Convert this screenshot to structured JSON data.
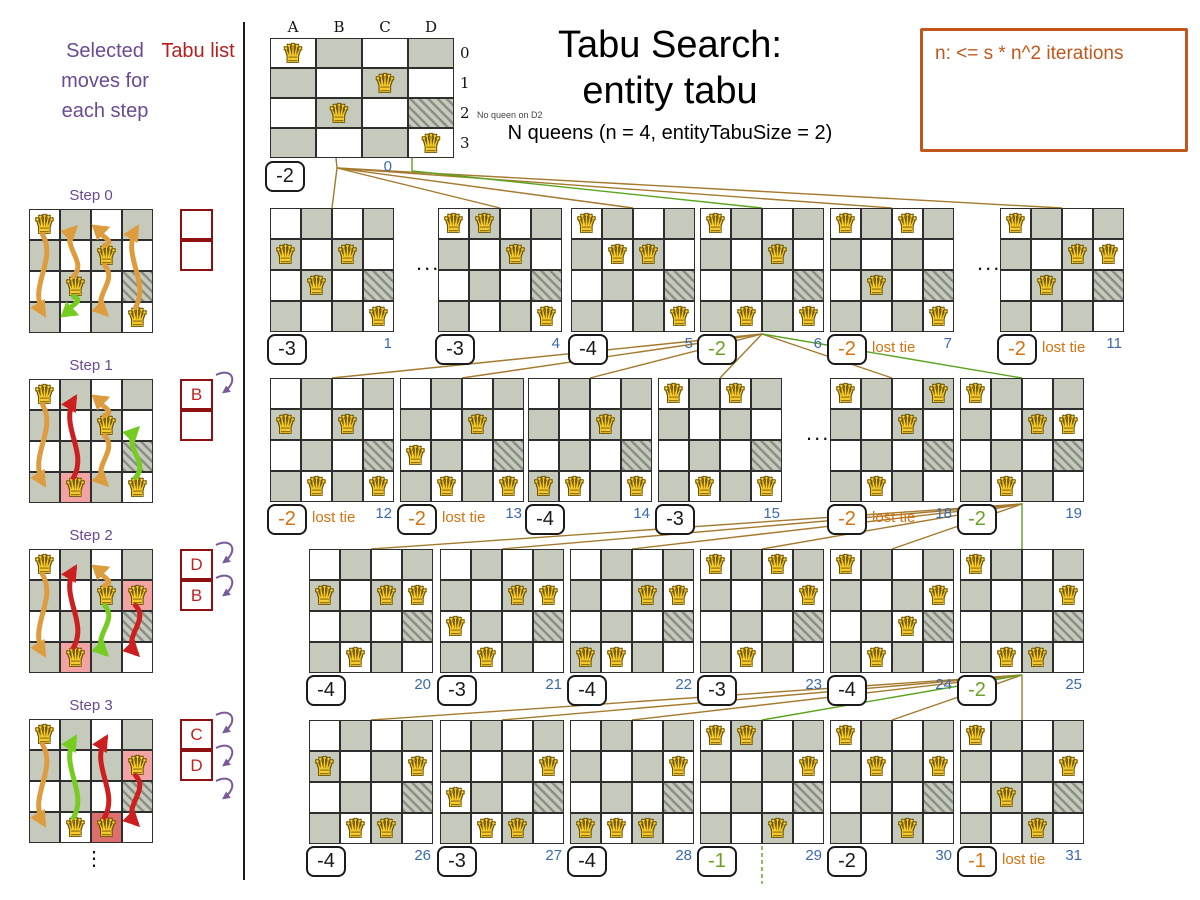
{
  "left_panel": {
    "moves_header": "Selected moves for each step",
    "tabu_header": "Tabu list",
    "ellipsis": "⋮",
    "steps": [
      {
        "label": "Step 0",
        "queens": [
          "A0",
          "C1",
          "B2",
          "D3"
        ],
        "tabu_cell": "D2",
        "highlights": [],
        "tabu_list": [
          "",
          ""
        ],
        "arrow_count": 0,
        "arrows": [
          {
            "col": "A",
            "from": 0,
            "to": 3,
            "color": "orange"
          },
          {
            "col": "B",
            "from": 2,
            "to": 0,
            "color": "orange"
          },
          {
            "col": "B",
            "from": 2,
            "to": 3,
            "color": "green"
          },
          {
            "col": "C",
            "from": 1,
            "to": 0,
            "color": "orange"
          },
          {
            "col": "C",
            "from": 1,
            "to": 3,
            "color": "orange"
          },
          {
            "col": "D",
            "from": 3,
            "to": 0,
            "color": "orange"
          }
        ]
      },
      {
        "label": "Step 1",
        "queens": [
          "A0",
          "C1",
          "B3",
          "D3"
        ],
        "tabu_cell": "D2",
        "highlights": [
          {
            "cell": "B3",
            "strength": "light"
          }
        ],
        "tabu_list": [
          "B",
          ""
        ],
        "arrow_count": 1,
        "arrows": [
          {
            "col": "A",
            "from": 0,
            "to": 3,
            "color": "orange"
          },
          {
            "col": "B",
            "from": 3,
            "to": 0,
            "color": "red"
          },
          {
            "col": "C",
            "from": 1,
            "to": 0,
            "color": "orange"
          },
          {
            "col": "C",
            "from": 1,
            "to": 3,
            "color": "orange"
          },
          {
            "col": "D",
            "from": 3,
            "to": 1,
            "color": "green"
          }
        ]
      },
      {
        "label": "Step 2",
        "queens": [
          "A0",
          "C1",
          "D1",
          "B3"
        ],
        "tabu_cell": "D2",
        "highlights": [
          {
            "cell": "D1",
            "strength": "light"
          },
          {
            "cell": "B3",
            "strength": "light"
          }
        ],
        "tabu_list": [
          "D",
          "B"
        ],
        "arrow_count": 2,
        "arrows": [
          {
            "col": "A",
            "from": 0,
            "to": 3,
            "color": "orange"
          },
          {
            "col": "B",
            "from": 3,
            "to": 0,
            "color": "red"
          },
          {
            "col": "C",
            "from": 1,
            "to": 0,
            "color": "orange"
          },
          {
            "col": "C",
            "from": 1,
            "to": 3,
            "color": "green"
          },
          {
            "col": "D",
            "from": 1,
            "to": 3,
            "color": "red"
          }
        ]
      },
      {
        "label": "Step 3",
        "queens": [
          "A0",
          "D1",
          "B3",
          "C3"
        ],
        "tabu_cell": "D2",
        "highlights": [
          {
            "cell": "D1",
            "strength": "light"
          },
          {
            "cell": "C3",
            "strength": "strong"
          }
        ],
        "tabu_list": [
          "C",
          "D"
        ],
        "arrow_count": 3,
        "arrows": [
          {
            "col": "A",
            "from": 0,
            "to": 3,
            "color": "orange"
          },
          {
            "col": "B",
            "from": 3,
            "to": 0,
            "color": "green"
          },
          {
            "col": "C",
            "from": 3,
            "to": 0,
            "color": "red"
          },
          {
            "col": "D",
            "from": 1,
            "to": 3,
            "color": "red"
          }
        ]
      }
    ]
  },
  "header": {
    "title_line1": "Tabu Search:",
    "title_line2": "entity tabu",
    "subtitle": "N queens (n = 4, entityTabuSize = 2)",
    "note": "n: <= s * n^2 iterations"
  },
  "start_board": {
    "column_labels": [
      "A",
      "B",
      "C",
      "D"
    ],
    "row_labels": [
      "0",
      "1",
      "2",
      "3"
    ],
    "queens": [
      "A0",
      "C1",
      "B2",
      "D3"
    ],
    "tabu_cell": "D2",
    "annotation": "No queen on D2",
    "score": "-2",
    "index": "0"
  },
  "dots_label": "...",
  "lost_tie_label": "lost tie",
  "move_boards": [
    {
      "index": "1",
      "row": 1,
      "slot": 0,
      "score": "-3",
      "color": "black",
      "lost_tie": false,
      "selected": false,
      "queens": [
        "A1",
        "C1",
        "B2",
        "D3"
      ],
      "tabu_cell": "D2"
    },
    {
      "index": "4",
      "row": 1,
      "slot": 1,
      "score": "-3",
      "color": "black",
      "lost_tie": false,
      "selected": false,
      "queens": [
        "A0",
        "B0",
        "C1",
        "D3"
      ],
      "tabu_cell": "D2"
    },
    {
      "index": "5",
      "row": 1,
      "slot": 2,
      "score": "-4",
      "color": "black",
      "lost_tie": false,
      "selected": false,
      "queens": [
        "A0",
        "B1",
        "C1",
        "D3"
      ],
      "tabu_cell": "D2"
    },
    {
      "index": "6",
      "row": 1,
      "slot": 3,
      "score": "-2",
      "color": "green",
      "lost_tie": false,
      "selected": true,
      "queens": [
        "A0",
        "C1",
        "B3",
        "D3"
      ],
      "tabu_cell": "D2"
    },
    {
      "index": "7",
      "row": 1,
      "slot": 4,
      "score": "-2",
      "color": "orange",
      "lost_tie": true,
      "selected": false,
      "queens": [
        "A0",
        "C0",
        "B2",
        "D3"
      ],
      "tabu_cell": "D2"
    },
    {
      "index": "11",
      "row": 1,
      "slot": 5,
      "score": "-2",
      "color": "orange",
      "lost_tie": true,
      "selected": false,
      "queens": [
        "A0",
        "C1",
        "D1",
        "B2"
      ],
      "tabu_cell": "D2"
    },
    {
      "index": "12",
      "row": 2,
      "slot": 0,
      "score": "-2",
      "color": "orange",
      "lost_tie": true,
      "selected": false,
      "queens": [
        "A1",
        "C1",
        "B3",
        "D3"
      ],
      "tabu_cell": "D2"
    },
    {
      "index": "13",
      "row": 2,
      "slot": 1,
      "score": "-2",
      "color": "orange",
      "lost_tie": true,
      "selected": false,
      "queens": [
        "A2",
        "C1",
        "B3",
        "D3"
      ],
      "tabu_cell": "D2"
    },
    {
      "index": "14",
      "row": 2,
      "slot": 2,
      "score": "-4",
      "color": "black",
      "lost_tie": false,
      "selected": false,
      "queens": [
        "A3",
        "C1",
        "B3",
        "D3"
      ],
      "tabu_cell": "D2"
    },
    {
      "index": "15",
      "row": 2,
      "slot": 3,
      "score": "-3",
      "color": "black",
      "lost_tie": false,
      "selected": false,
      "queens": [
        "A0",
        "C0",
        "B3",
        "D3"
      ],
      "tabu_cell": "D2"
    },
    {
      "index": "18",
      "row": 2,
      "slot": 4,
      "score": "-2",
      "color": "orange",
      "lost_tie": true,
      "selected": false,
      "queens": [
        "A0",
        "D0",
        "C1",
        "B3"
      ],
      "tabu_cell": "D2"
    },
    {
      "index": "19",
      "row": 2,
      "slot": 5,
      "score": "-2",
      "color": "green",
      "lost_tie": false,
      "selected": true,
      "queens": [
        "A0",
        "C1",
        "D1",
        "B3"
      ],
      "tabu_cell": "D2"
    },
    {
      "index": "20",
      "row": 3,
      "slot": 0,
      "score": "-4",
      "color": "black",
      "lost_tie": false,
      "selected": false,
      "queens": [
        "A1",
        "C1",
        "D1",
        "B3"
      ],
      "tabu_cell": "D2"
    },
    {
      "index": "21",
      "row": 3,
      "slot": 1,
      "score": "-3",
      "color": "black",
      "lost_tie": false,
      "selected": false,
      "queens": [
        "A2",
        "C1",
        "D1",
        "B3"
      ],
      "tabu_cell": "D2"
    },
    {
      "index": "22",
      "row": 3,
      "slot": 2,
      "score": "-4",
      "color": "black",
      "lost_tie": false,
      "selected": false,
      "queens": [
        "A3",
        "C1",
        "D1",
        "B3"
      ],
      "tabu_cell": "D2"
    },
    {
      "index": "23",
      "row": 3,
      "slot": 3,
      "score": "-3",
      "color": "black",
      "lost_tie": false,
      "selected": false,
      "queens": [
        "A0",
        "C0",
        "D1",
        "B3"
      ],
      "tabu_cell": "D2"
    },
    {
      "index": "24",
      "row": 3,
      "slot": 4,
      "score": "-4",
      "color": "black",
      "lost_tie": false,
      "selected": false,
      "queens": [
        "A0",
        "D1",
        "C2",
        "B3"
      ],
      "tabu_cell": "D2"
    },
    {
      "index": "25",
      "row": 3,
      "slot": 5,
      "score": "-2",
      "color": "green",
      "lost_tie": false,
      "selected": true,
      "queens": [
        "A0",
        "D1",
        "B3",
        "C3"
      ],
      "tabu_cell": "D2"
    },
    {
      "index": "26",
      "row": 4,
      "slot": 0,
      "score": "-4",
      "color": "black",
      "lost_tie": false,
      "selected": false,
      "queens": [
        "A1",
        "D1",
        "B3",
        "C3"
      ],
      "tabu_cell": "D2"
    },
    {
      "index": "27",
      "row": 4,
      "slot": 1,
      "score": "-3",
      "color": "black",
      "lost_tie": false,
      "selected": false,
      "queens": [
        "A2",
        "D1",
        "B3",
        "C3"
      ],
      "tabu_cell": "D2"
    },
    {
      "index": "28",
      "row": 4,
      "slot": 2,
      "score": "-4",
      "color": "black",
      "lost_tie": false,
      "selected": false,
      "queens": [
        "A3",
        "D1",
        "B3",
        "C3"
      ],
      "tabu_cell": "D2"
    },
    {
      "index": "29",
      "row": 4,
      "slot": 3,
      "score": "-1",
      "color": "green",
      "lost_tie": false,
      "selected": true,
      "queens": [
        "A0",
        "B0",
        "D1",
        "C3"
      ],
      "tabu_cell": "D2"
    },
    {
      "index": "30",
      "row": 4,
      "slot": 4,
      "score": "-2",
      "color": "black",
      "lost_tie": false,
      "selected": false,
      "queens": [
        "A0",
        "B1",
        "D1",
        "C3"
      ],
      "tabu_cell": "D2"
    },
    {
      "index": "31",
      "row": 4,
      "slot": 5,
      "score": "-1",
      "color": "orange",
      "lost_tie": true,
      "selected": false,
      "queens": [
        "A0",
        "D1",
        "B2",
        "C3"
      ],
      "tabu_cell": "D2"
    }
  ],
  "colors": {
    "purple": "#6b4a94",
    "red": "#b51f1f",
    "dark_red": "#8f1010",
    "note_orange": "#c0571c",
    "score_orange": "#d4730f",
    "score_green": "#6aa121",
    "line_green": "#5aa41e",
    "line_brown": "#a57a2e",
    "index_blue": "#3a6aad",
    "board_gray": "#c6cabd",
    "queen_gold": "#f7c92d",
    "arrow_orange": "#dd9d3f",
    "arrow_red": "#cc2020",
    "arrow_green": "#77cc22"
  }
}
